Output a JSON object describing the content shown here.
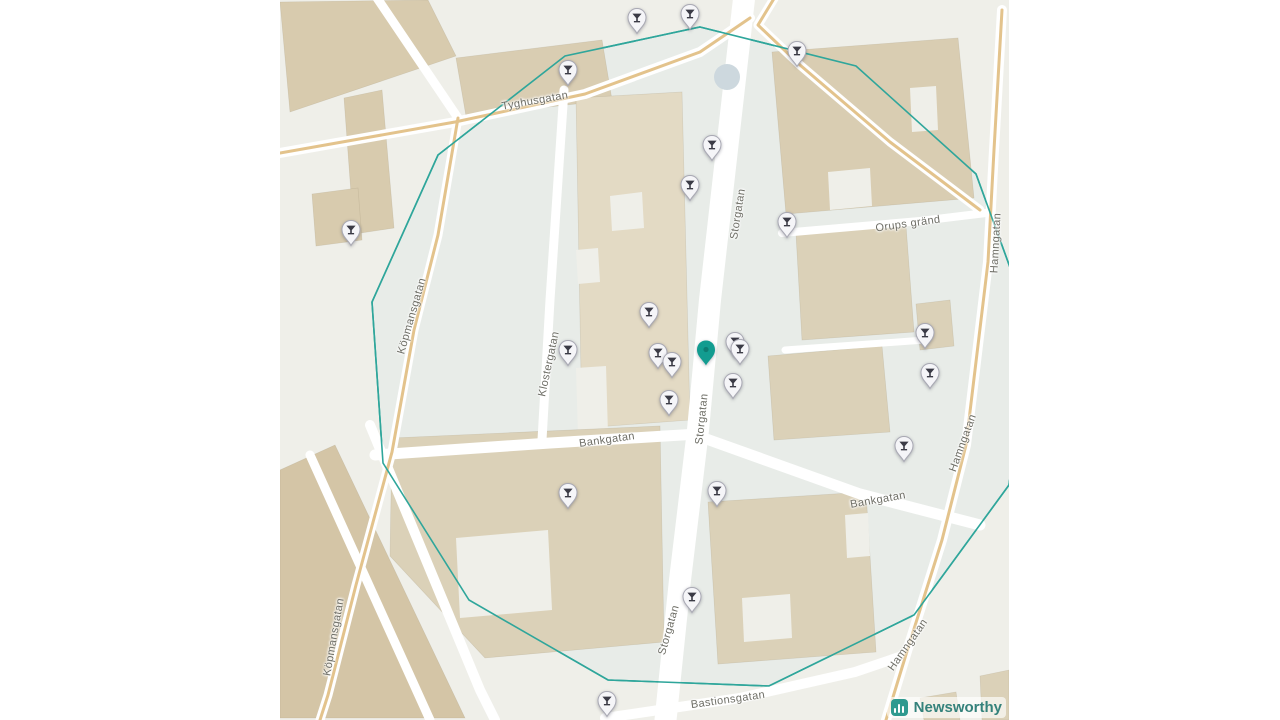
{
  "map": {
    "attribution": {
      "brand": "Newsworthy"
    },
    "colors": {
      "circle": "#2fa69b",
      "pin_teal": "#129c90",
      "pin_grey": "#f5f5f8",
      "glyph_dark": "#3b3b46",
      "road_main": "#e3c38c",
      "brand_teal": "#2f9a8f",
      "brand_text": "#35827b"
    },
    "street_labels": [
      {
        "text": "Tyghusgatan",
        "x": 255,
        "y": 101,
        "rot": -10
      },
      {
        "text": "Storgatan",
        "x": 458,
        "y": 214,
        "rot": -81
      },
      {
        "text": "Storgatan",
        "x": 422,
        "y": 419,
        "rot": -84
      },
      {
        "text": "Storgatan",
        "x": 389,
        "y": 630,
        "rot": -74
      },
      {
        "text": "Köpmansgatan",
        "x": 132,
        "y": 316,
        "rot": -74
      },
      {
        "text": "Köpmansgatan",
        "x": 54,
        "y": 637,
        "rot": -80
      },
      {
        "text": "Klostergatan",
        "x": 269,
        "y": 364,
        "rot": -78
      },
      {
        "text": "Bankgatan",
        "x": 327,
        "y": 440,
        "rot": -8
      },
      {
        "text": "Bankgatan",
        "x": 598,
        "y": 500,
        "rot": -10
      },
      {
        "text": "Orups gränd",
        "x": 628,
        "y": 224,
        "rot": -8
      },
      {
        "text": "Hamngatan",
        "x": 716,
        "y": 243,
        "rot": -87
      },
      {
        "text": "Hamngatan",
        "x": 683,
        "y": 443,
        "rot": -70
      },
      {
        "text": "Hamngatan",
        "x": 628,
        "y": 645,
        "rot": -55
      },
      {
        "text": "Bastionsgatan",
        "x": 448,
        "y": 700,
        "rot": -8
      }
    ],
    "venue_markers": {
      "icon": "cocktail-glass-icon",
      "points": [
        [
          357,
          18
        ],
        [
          410,
          14
        ],
        [
          288,
          70
        ],
        [
          517,
          51
        ],
        [
          432,
          145
        ],
        [
          410,
          185
        ],
        [
          507,
          222
        ],
        [
          71,
          230
        ],
        [
          369,
          312
        ],
        [
          645,
          333
        ],
        [
          288,
          350
        ],
        [
          378,
          353
        ],
        [
          455,
          342
        ],
        [
          460,
          349
        ],
        [
          392,
          362
        ],
        [
          650,
          373
        ],
        [
          453,
          383
        ],
        [
          389,
          400
        ],
        [
          624,
          446
        ],
        [
          288,
          493
        ],
        [
          437,
          491
        ],
        [
          412,
          597
        ],
        [
          327,
          701
        ]
      ]
    },
    "center_marker": {
      "x": 426,
      "y": 350
    }
  }
}
